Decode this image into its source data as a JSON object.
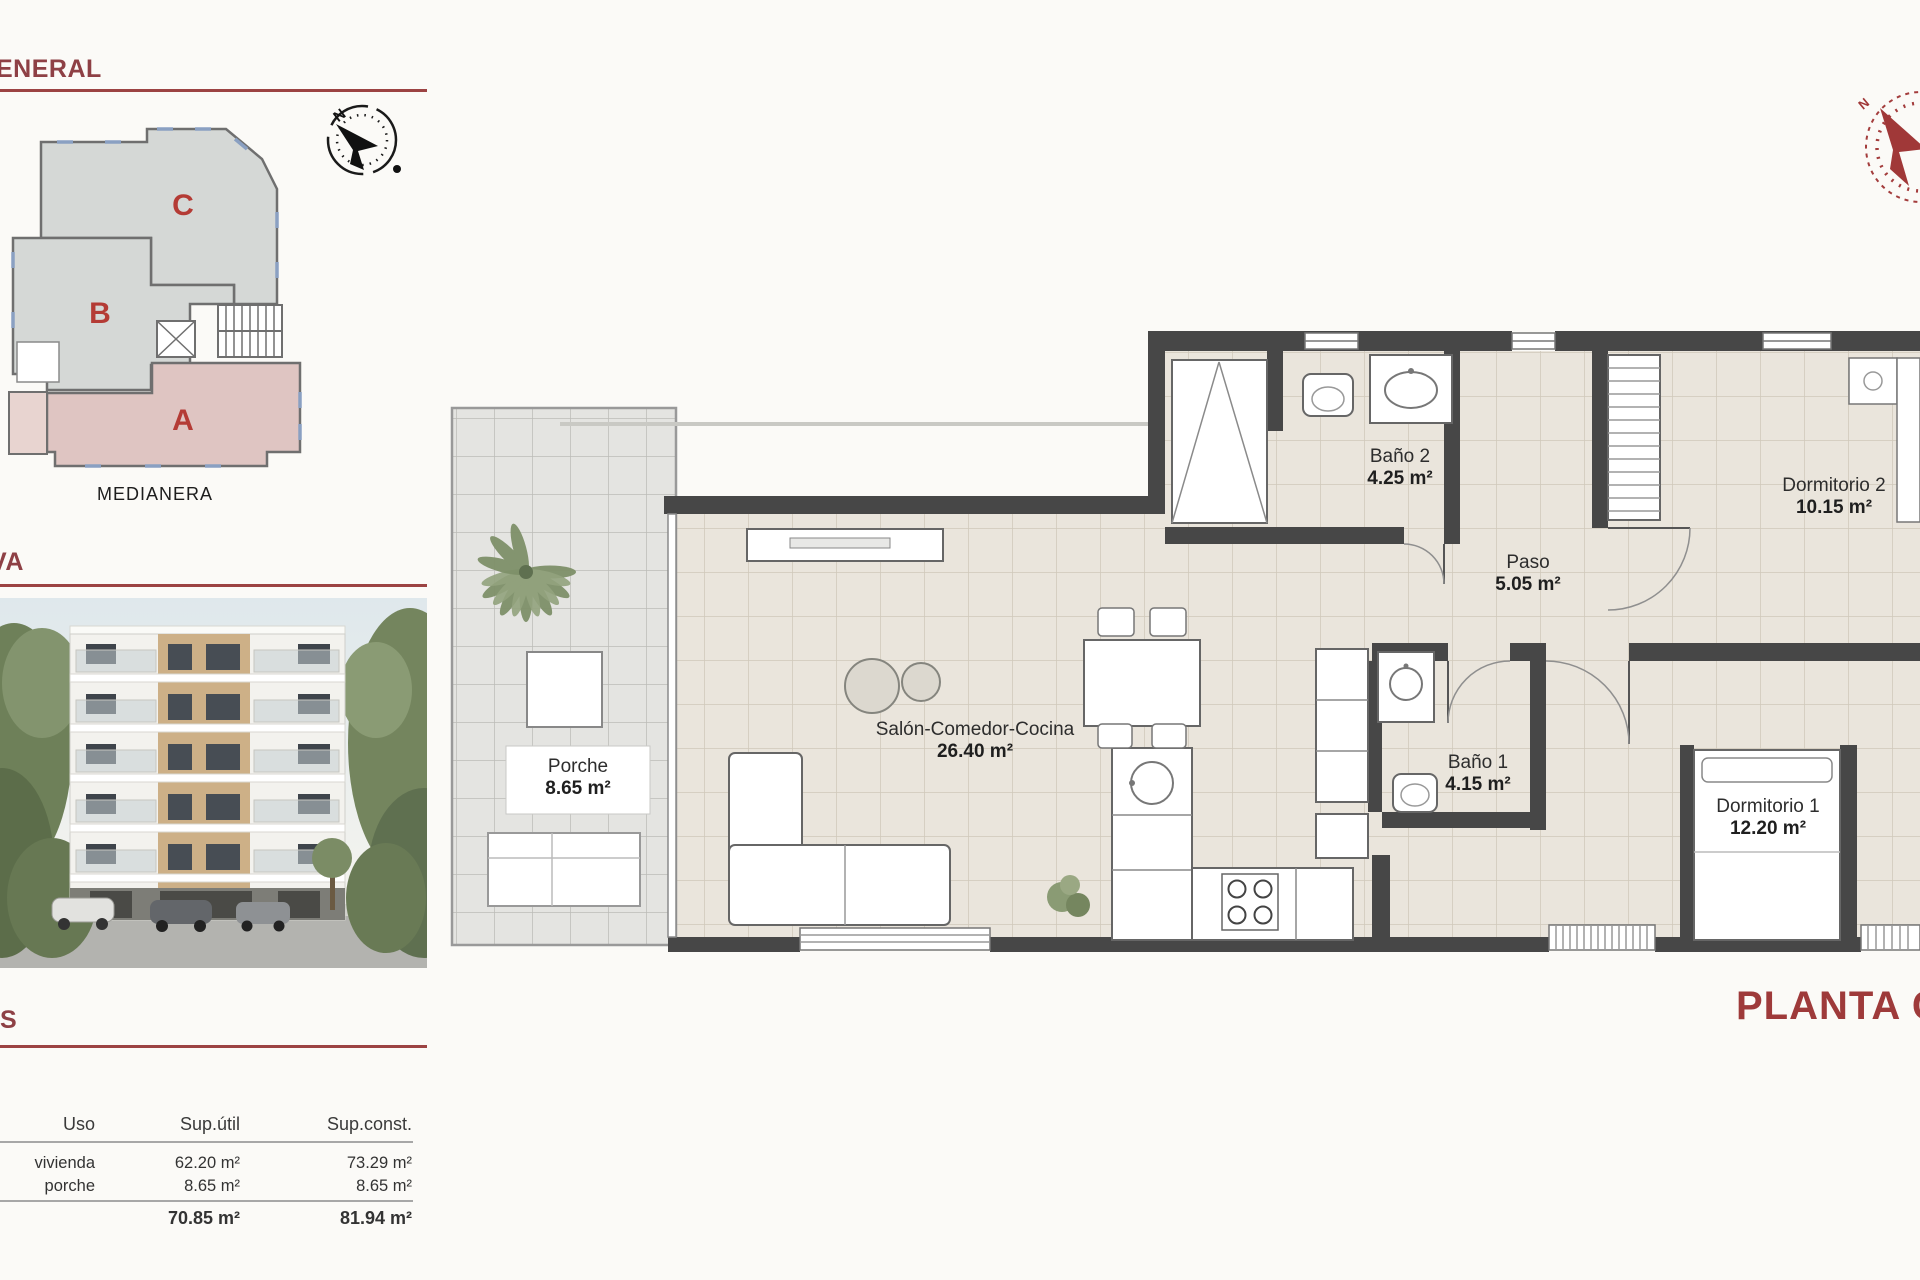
{
  "accent": "#9c4343",
  "compass_north": "N",
  "sections": {
    "general": {
      "title": "ENERAL",
      "caption": "MEDIANERA",
      "units": {
        "a": "A",
        "b": "B",
        "c": "C"
      }
    },
    "render": {
      "title": "VA"
    },
    "surfaces": {
      "title": "S",
      "table": {
        "col_uso": "Uso",
        "col_util": "Sup.útil",
        "col_const": "Sup.const.",
        "rows": [
          {
            "uso": "vivienda",
            "util": "62.20 m²",
            "const": "73.29 m²"
          },
          {
            "uso": "porche",
            "util": "8.65 m²",
            "const": "8.65 m²"
          }
        ],
        "total_util": "70.85 m²",
        "total_const": "81.94 m²"
      }
    }
  },
  "plan": {
    "title": "PLANTA CUA",
    "rooms": {
      "porche": {
        "name": "Porche",
        "area": "8.65 m²"
      },
      "salon": {
        "name": "Salón-Comedor-Cocina",
        "area": "26.40 m²"
      },
      "bano2": {
        "name": "Baño 2",
        "area": "4.25 m²"
      },
      "paso": {
        "name": "Paso",
        "area": "5.05 m²"
      },
      "dorm2": {
        "name": "Dormitorio 2",
        "area": "10.15 m²"
      },
      "bano1": {
        "name": "Baño 1",
        "area": "4.15 m²"
      },
      "dorm1": {
        "name": "Dormitorio 1",
        "area": "12.20 m²"
      }
    }
  }
}
